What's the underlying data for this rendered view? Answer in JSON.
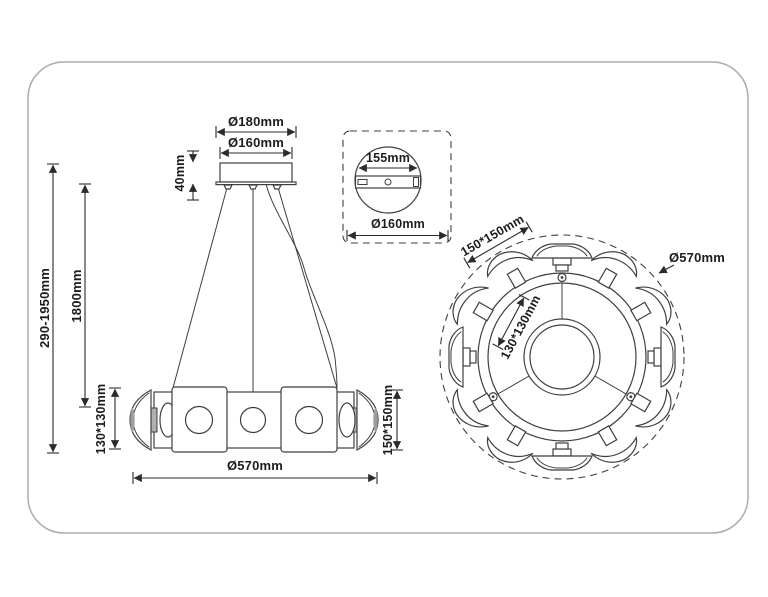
{
  "colors": {
    "background": "#ffffff",
    "frame_border": "#ababab",
    "drawing_line": "#3f3f3f",
    "dimension_text": "#1c1c1c",
    "shaded_fill": "#b0b0b0"
  },
  "front_view": {
    "dim_canopy_outer_diameter": "Ø180mm",
    "dim_canopy_inner_diameter": "Ø160mm",
    "dim_canopy_height": "40mm",
    "dim_overall_height_range": "290-1950mm",
    "dim_suspension_length": "1800mm",
    "dim_side_lens_size": "130*130mm",
    "dim_end_lens_size": "150*150mm",
    "dim_body_diameter": "Ø570mm"
  },
  "detail_view": {
    "dim_bracket_length": "155mm",
    "dim_canopy_plate_diameter": "Ø160mm"
  },
  "top_view": {
    "dim_large_lens_size": "150*150mm",
    "dim_small_lens_size": "130*130mm",
    "dim_body_diameter": "Ø570mm"
  }
}
